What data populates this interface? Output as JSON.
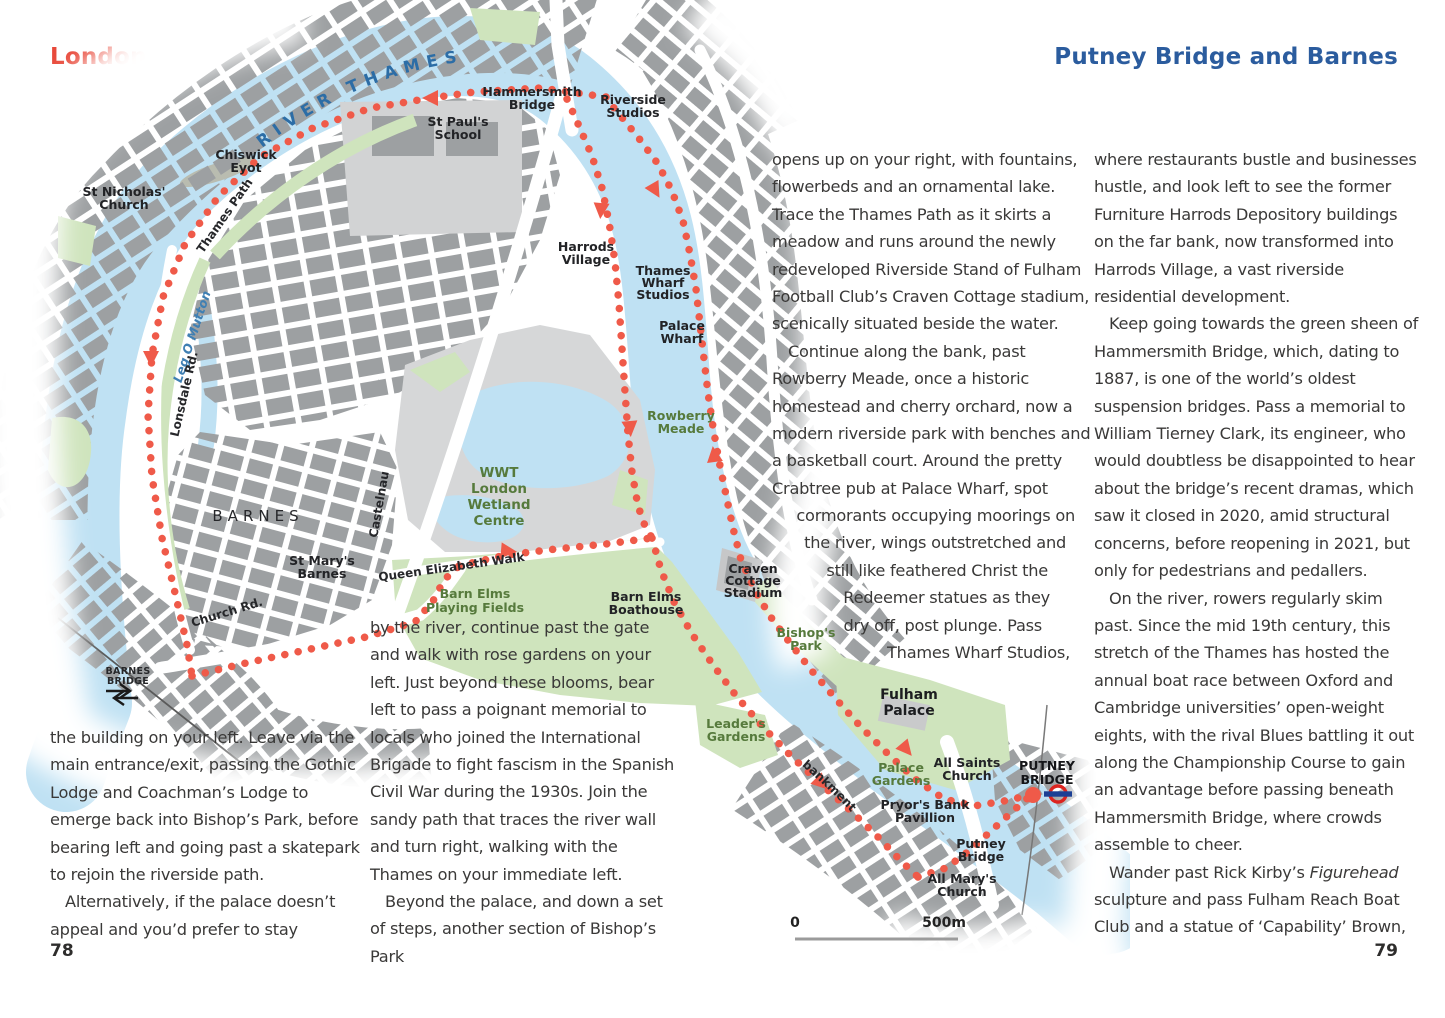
{
  "page": {
    "region_label": "London",
    "title": "Putney Bridge and Barnes",
    "page_left": "78",
    "page_right": "79",
    "colors": {
      "title_red": "#e8493a",
      "title_blue": "#2b5c9e",
      "route_red": "#ef5a49",
      "river_blue": "#bfe1f3",
      "park_green": "#cfe4bd",
      "building_gray": "#9da0a2",
      "underground_red": "#dc241f",
      "underground_blue": "#1c3f94"
    }
  },
  "walk_text": {
    "col_mid_lines": [
      {
        "t": "opens up on your right, with fountains,"
      },
      {
        "t": "flowerbeds and an ornamental lake."
      },
      {
        "t": "Trace the Thames Path as it skirts a"
      },
      {
        "t": "meadow and runs around the newly"
      },
      {
        "t": "redeveloped Riverside Stand of Fulham"
      },
      {
        "t": "Football Club’s Craven Cottage stadium,"
      },
      {
        "t": "scenically situated beside the water."
      },
      {
        "t": "Continue along the bank, past",
        "in": 16
      },
      {
        "t": "Rowberry Meade, once a historic"
      },
      {
        "t": "homestead and cherry orchard, now a"
      },
      {
        "t": "modern riverside park with benches and"
      },
      {
        "t": "a basketball court. Around the pretty"
      },
      {
        "t": "Crabtree pub at Palace Wharf, spot",
        "r": 40
      },
      {
        "t": "cormorants occupying moorings on",
        "r": 3
      },
      {
        "t": "the river, wings outstretched and",
        "r": 12
      },
      {
        "t": "still like feathered Christ the",
        "r": 30
      },
      {
        "t": "Redeemer statues as they",
        "r": 28
      },
      {
        "t": "dry off, post plunge. Pass",
        "r": 36
      },
      {
        "t": "Thames Wharf Studios,",
        "r": 8
      }
    ],
    "col_right_paras": [
      {
        "t": "where restaurants bustle and businesses hustle, and look left to see the former Furniture Harrods Depository buildings on the far bank, now transformed into Harrods Village, a vast riverside residential development."
      },
      {
        "t": "Keep going towards the green sheen of Hammersmith Bridge, which, dating to 1887, is one of the world’s oldest suspension bridges. Pass a memorial to William Tierney Clark, its engineer, who would doubtless be disappointed to hear about the bridge’s recent dramas, which saw it closed in 2020, amid structural concerns, before reopening in 2021, but only for pedestrians and pedallers.",
        "indent": true
      },
      {
        "t": "On the river, rowers regularly skim past. Since the mid 19th century, this stretch of the Thames has hosted the annual boat race between Oxford and Cambridge universities’ open-weight eights, with the rival Blues battling it out along the Championship Course to gain an advantage before passing beneath Hammersmith Bridge, where crowds assemble to cheer.",
        "indent": true
      },
      {
        "t": "Wander past Rick Kirby’s *Figurehead* sculpture and pass Fulham Reach Boat Club and a statue of ‘Capability’ Brown,",
        "indent": true
      }
    ],
    "col_bottom_left_paras": [
      {
        "t": "the building on your left. Leave via the main entrance/exit, passing the Gothic Lodge and Coachman’s Lodge to emerge back into Bishop’s Park, before bearing left and going past a skatepark to rejoin the riverside path."
      },
      {
        "t": "Alternatively, if the palace doesn’t appeal and you’d prefer to stay",
        "indent": true
      }
    ],
    "col_bottom_mid_paras": [
      {
        "t": "by the river, continue past the gate and walk with rose gardens on your left. Just beyond these blooms, bear left to pass a poignant memorial to locals who joined the International Brigade to fight fascism in the Spanish Civil War during the 1930s. Join the sandy path that traces the river wall and turn right, walking with the Thames on your immediate left."
      },
      {
        "t": "Beyond the palace, and down a set of steps, another section of Bishop’s Park",
        "indent": true
      }
    ]
  },
  "map": {
    "river_label": "RIVER THAMES",
    "scale": {
      "start": "0",
      "end": "500m"
    },
    "labels": {
      "hammersmith_bridge": [
        "Hammersmith",
        "Bridge"
      ],
      "riverside_studios": [
        "Riverside",
        "Studios"
      ],
      "st_pauls_school": [
        "St Paul's",
        "School"
      ],
      "chiswick_eyot": [
        "Chiswick",
        "Eyot"
      ],
      "st_nicholas_church": [
        "St Nicholas'",
        "Church"
      ],
      "thames_path": "Thames Path",
      "leg_o_mutton": "Leg O Mutton",
      "lonsdale_rd": "Lonsdale Rd.",
      "harrods_village": [
        "Harrods",
        "Village"
      ],
      "thames_wharf_studios": [
        "Thames",
        "Wharf",
        "Studios"
      ],
      "palace_wharf": [
        "Palace",
        "Wharf"
      ],
      "rowberry_meade": [
        "Rowberry",
        "Meade"
      ],
      "barnes": "BARNES",
      "castelnau": "Castelnau",
      "wwt": [
        "WWT",
        "London",
        "Wetland",
        "Centre"
      ],
      "st_marys_barnes": [
        "St Mary's",
        "Barnes"
      ],
      "queen_elizabeth_walk": "Queen Elizabeth Walk",
      "church_rd": "Church Rd.",
      "barn_elms_playing_fields": [
        "Barn Elms",
        "Playing Fields"
      ],
      "barn_elms_boathouse": [
        "Barn Elms",
        "Boathouse"
      ],
      "craven_cottage_stadium": [
        "Craven",
        "Cottage",
        "Stadium"
      ],
      "bishops_park": [
        "Bishop's",
        "Park"
      ],
      "leaders_gardens": [
        "Leader's",
        "Gardens"
      ],
      "fulham_palace": [
        "Fulham",
        "Palace"
      ],
      "palace_gardens": [
        "Palace",
        "Gardens"
      ],
      "all_saints_church": [
        "All Saints",
        "Church"
      ],
      "putney_bridge_station": [
        "PUTNEY",
        "BRIDGE"
      ],
      "pryors_bank_pavillion": [
        "Pryor's Bank",
        "Pavillion"
      ],
      "putney_bridge": [
        "Putney",
        "Bridge"
      ],
      "all_marys_church": [
        "All Mary's",
        "Church"
      ],
      "putney_embankment": "Putney Embankment",
      "barnes_bridge": [
        "BARNES",
        "BRIDGE"
      ]
    },
    "icons": {
      "underground_roundel": "london-underground-roundel",
      "national_rail": "national-rail-icon",
      "route_start_dot": "walk-start-dot"
    }
  }
}
